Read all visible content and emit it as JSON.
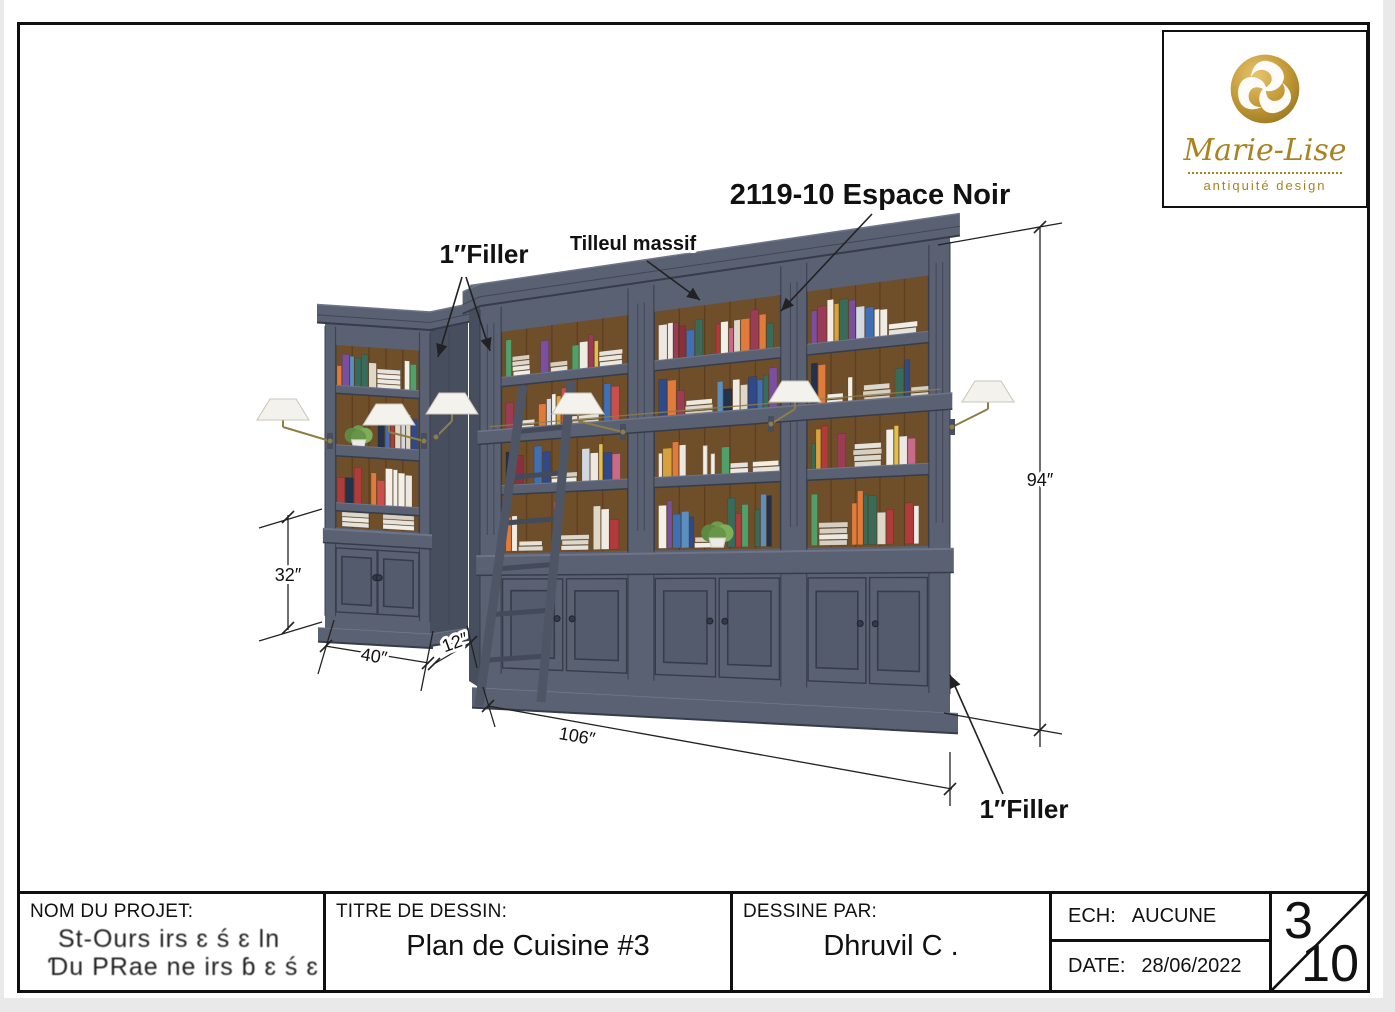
{
  "logo": {
    "name": "Marie-Lise",
    "tagline": "antiquité design",
    "gold": "#a9831f"
  },
  "drawing": {
    "annotations": {
      "filler_top": "1″Filler",
      "material": "Tilleul massif",
      "product_code": "2119-10 Espace Noir",
      "filler_bottom": "1″Filler"
    },
    "dimensions": {
      "total_height": "94″",
      "base_height": "32″",
      "small_unit_width": "40″",
      "small_unit_depth": "12″",
      "large_unit_width": "106″"
    },
    "colors": {
      "cabinet": "#5a6173",
      "cabinet_dark": "#474e5e",
      "cabinet_darker": "#363c4a",
      "cabinet_light": "#6e7588",
      "door_panel": "#535b6d",
      "wood_back": "#6f4e2a",
      "wood_dark": "#57391d",
      "lamp_shade": "#f4f2ec",
      "brass": "#8f7d48",
      "line": "#222222"
    },
    "book_palette": [
      "#c94f4f",
      "#ece8e1",
      "#3f6fb5",
      "#d9a13b",
      "#7a4fa0",
      "#4fa06a",
      "#d2d8e2",
      "#b13a3a",
      "#2e4a8a",
      "#e2c04f",
      "#f0ece4",
      "#386b5a",
      "#c96a8a",
      "#23324a",
      "#e07b3c",
      "#8a2f3c",
      "#5a8fc0",
      "#ded8c8",
      "#f3f0ea",
      "#9b3b55"
    ]
  },
  "title_block": {
    "project_label": "NOM DU PROJET:",
    "project_line1": "St-Ours irs ɛ ś ɛ ln",
    "project_line2": "Ɗu PRae ne irs ɓ ɛ ś ɛ",
    "drawing_label": "TITRE DE DESSIN:",
    "drawing_title": "Plan de Cuisine #3",
    "author_label": "DESSINE PAR:",
    "author": "Dhruvil C .",
    "scale_label": "ECH:",
    "scale": "AUCUNE",
    "date_label": "DATE:",
    "date": "28/06/2022",
    "sheet_number": "3",
    "sheet_count": "10"
  }
}
